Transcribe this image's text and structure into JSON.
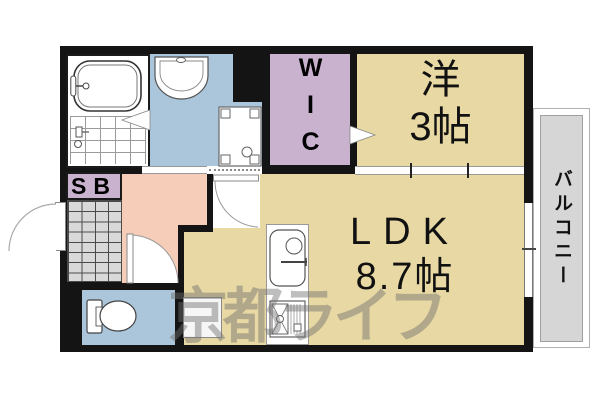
{
  "floorplan": {
    "watermark_text": "京都ライフ",
    "rooms": {
      "western": {
        "name": "洋",
        "size": "3帖"
      },
      "ldk": {
        "name": "LDK",
        "size": "8.7帖"
      },
      "wic": {
        "label": "WIC"
      },
      "balcony": {
        "label": "バルコニー"
      },
      "shoe_box": {
        "label": "SB"
      }
    },
    "fixtures": {
      "bathtub": "bathtub",
      "shower": "shower",
      "washbasin": "washbasin",
      "washing_machine_pan": "washing-machine-pan",
      "toilet": "toilet",
      "kitchen_sink": "kitchen-sink",
      "gas_stove": "gas-stove",
      "refrigerator_space": "refrigerator-space"
    },
    "colors": {
      "wall": "#141414",
      "room_tan": "#e8d8a4",
      "closet_purple": "#c8b2ce",
      "wet_blue": "#abc5da",
      "hall_pink": "#f6cdb9",
      "entrance_tile": "#d9d9d9",
      "balcony_gray": "#d6d6d6",
      "watermark_gray": "#6e6e6e"
    }
  }
}
